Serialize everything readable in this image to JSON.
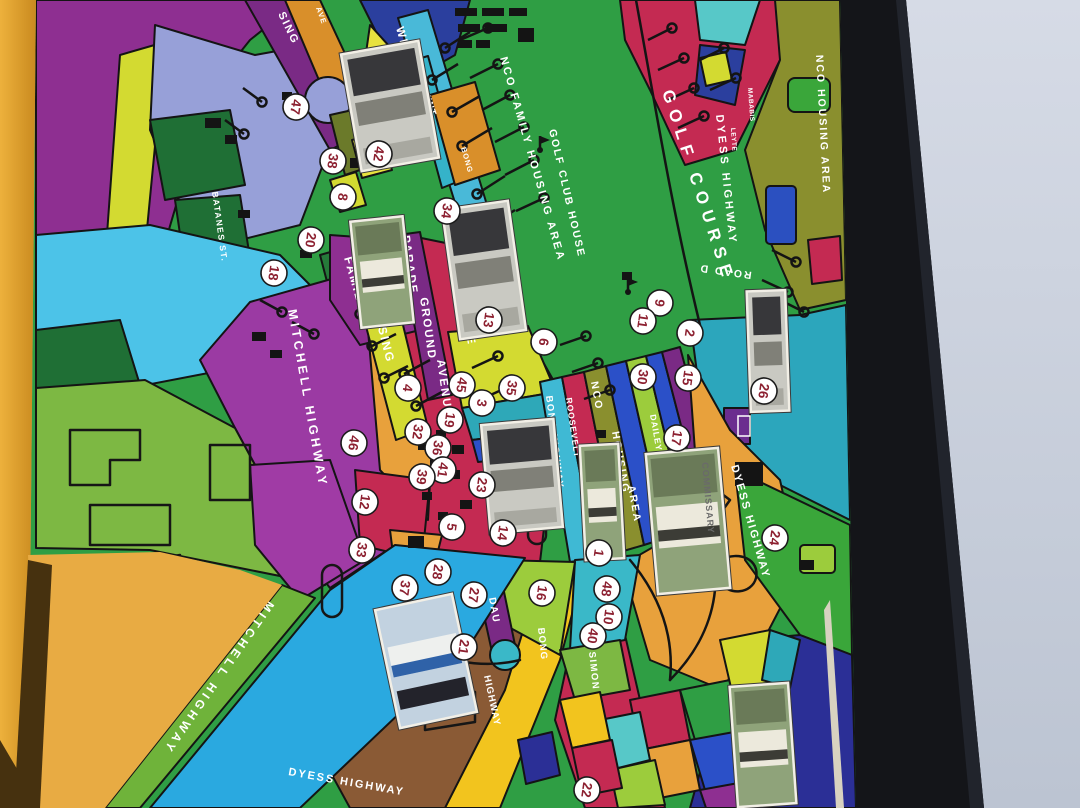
{
  "scene": {
    "left_wall_color": "#e09b2e",
    "right_wall_color": "#c9cfdb",
    "frame_color": "#141519",
    "map_edge_color": "#d8d2c0",
    "palette": {
      "golf_green": "#2f9e44",
      "lime_green": "#7db843",
      "purple": "#8e2f91",
      "violet_road": "#7a2a85",
      "crimson": "#c42a52",
      "cyan_road": "#2aa9e0",
      "teal": "#2ca6bc",
      "periwinkle": "#97a0d8",
      "olive": "#8a8f2e",
      "orange": "#e8a13c",
      "gold": "#f2c41e",
      "brown": "#8a5a35",
      "royal_blue": "#2b50c8",
      "navy": "#2b2f96",
      "yellow_green": "#d3da31"
    }
  },
  "map": {
    "marker_style": {
      "fill": "#ffffff",
      "text_color": "#8c2030"
    },
    "labels": [
      {
        "id": "golf-course",
        "text": "GOLF COURSE",
        "x": 662,
        "y": 92,
        "rot": 72,
        "size": 17,
        "ls": 7
      },
      {
        "id": "nco-family-housing-area",
        "text": "NCO FAMILY HOUSING AREA",
        "x": 500,
        "y": 58,
        "rot": 74,
        "size": 11,
        "ls": 2.5
      },
      {
        "id": "golf-club-house",
        "text": "GOLF CLUB HOUSE",
        "x": 549,
        "y": 130,
        "rot": 77,
        "size": 10.5,
        "ls": 2
      },
      {
        "id": "nco-housing-area-right",
        "text": "NCO HOUSING AREA",
        "x": 816,
        "y": 55,
        "rot": 87,
        "size": 10.5,
        "ls": 2
      },
      {
        "id": "dyess-highway-top",
        "text": "DYESS HIGHWAY",
        "x": 716,
        "y": 115,
        "rot": 84,
        "size": 11,
        "ls": 3
      },
      {
        "id": "road-d",
        "text": "ROAD D",
        "x": 752,
        "y": 272,
        "rot": 188,
        "size": 10.5,
        "ls": 2
      },
      {
        "id": "mababis-st",
        "text": "MABABIS",
        "x": 748,
        "y": 88,
        "rot": 86,
        "size": 6.5,
        "ls": 0.5
      },
      {
        "id": "leyte-st",
        "text": "LEYTE",
        "x": 731,
        "y": 128,
        "rot": 86,
        "size": 6.5,
        "ls": 0.5
      },
      {
        "id": "housing-top-left",
        "text": "SING",
        "x": 278,
        "y": 14,
        "rot": 64,
        "size": 11,
        "ls": 2
      },
      {
        "id": "ave-top-left",
        "text": "AVE",
        "x": 316,
        "y": 8,
        "rot": 70,
        "size": 7.5,
        "ls": 1
      },
      {
        "id": "batanes-st",
        "text": "BATANES ST.",
        "x": 212,
        "y": 192,
        "rot": 82,
        "size": 8.5,
        "ls": 1.5
      },
      {
        "id": "wint",
        "text": "WINT",
        "x": 422,
        "y": 90,
        "rot": 72,
        "size": 9.5,
        "ls": 1
      },
      {
        "id": "bong-top",
        "text": "BONG",
        "x": 461,
        "y": 148,
        "rot": 74,
        "size": 7.5,
        "ls": 1
      },
      {
        "id": "wirt-davis",
        "text": "WIRT DAVIS",
        "x": 396,
        "y": 28,
        "rot": 74,
        "size": 11.5,
        "ls": 2
      },
      {
        "id": "avenue-wirt-davis",
        "text": "AVENUE",
        "x": 458,
        "y": 288,
        "rot": 80,
        "size": 11.5,
        "ls": 2
      },
      {
        "id": "parade",
        "text": "PARADE",
        "x": 402,
        "y": 236,
        "rot": 82,
        "size": 11.5,
        "ls": 2
      },
      {
        "id": "ground",
        "text": "GROUND",
        "x": 420,
        "y": 298,
        "rot": 82,
        "size": 11.5,
        "ls": 2
      },
      {
        "id": "avenue-parade-ground",
        "text": "AVENUE",
        "x": 437,
        "y": 360,
        "rot": 82,
        "size": 11.5,
        "ls": 2
      },
      {
        "id": "family",
        "text": "FAMILY",
        "x": 344,
        "y": 258,
        "rot": 74,
        "size": 12,
        "ls": 2
      },
      {
        "id": "housing-family",
        "text": "HOUSING",
        "x": 370,
        "y": 296,
        "rot": 76,
        "size": 12,
        "ls": 2
      },
      {
        "id": "mitchell-highway-mid",
        "text": "MITCHELL HIGHWAY",
        "x": 288,
        "y": 310,
        "rot": 80,
        "size": 12.5,
        "ls": 3.5
      },
      {
        "id": "bong-highway-mid",
        "text": "BONG HIGHWAY",
        "x": 546,
        "y": 396,
        "rot": 83,
        "size": 9.5,
        "ls": 1.5
      },
      {
        "id": "roosevelt",
        "text": "ROOSEVELT",
        "x": 566,
        "y": 398,
        "rot": 82,
        "size": 8.5,
        "ls": 1
      },
      {
        "id": "nco-band",
        "text": "NCO",
        "x": 591,
        "y": 382,
        "rot": 80,
        "size": 10.5,
        "ls": 2
      },
      {
        "id": "housing-band",
        "text": "HOUSING",
        "x": 612,
        "y": 432,
        "rot": 80,
        "size": 10.5,
        "ls": 2
      },
      {
        "id": "area-band",
        "text": "AREA",
        "x": 628,
        "y": 486,
        "rot": 80,
        "size": 10.5,
        "ls": 2
      },
      {
        "id": "dailey",
        "text": "DAILEY",
        "x": 650,
        "y": 415,
        "rot": 80,
        "size": 8.5,
        "ls": 1
      },
      {
        "id": "dyess-highway-right",
        "text": "DYESS HIGHWAY",
        "x": 731,
        "y": 466,
        "rot": 74,
        "size": 11,
        "ls": 2
      },
      {
        "id": "dau",
        "text": "DAU",
        "x": 489,
        "y": 598,
        "rot": 80,
        "size": 10,
        "ls": 1.5
      },
      {
        "id": "bong-bottom",
        "text": "BONG",
        "x": 538,
        "y": 628,
        "rot": 84,
        "size": 9.5,
        "ls": 1
      },
      {
        "id": "highway-bottom",
        "text": "HIGHWAY",
        "x": 484,
        "y": 676,
        "rot": 78,
        "size": 9.5,
        "ls": 1
      },
      {
        "id": "simon",
        "text": "SIMON",
        "x": 589,
        "y": 652,
        "rot": 84,
        "size": 9.5,
        "ls": 1.5
      },
      {
        "id": "mitchell-highway-bottom",
        "text": "MITCHELL HIGHWAY",
        "x": 268,
        "y": 600,
        "rot": 125,
        "size": 12,
        "ls": 4
      },
      {
        "id": "to-friendship-gate",
        "text": "TO FRIENDSHIP GATE",
        "x": 118,
        "y": 738,
        "rot": 125,
        "size": 8,
        "ls": 1
      },
      {
        "id": "dyess-highway-bottom",
        "text": "DYESS HIGHWAY",
        "x": 288,
        "y": 775,
        "rot": 10,
        "size": 11,
        "ls": 2
      }
    ],
    "markers": [
      {
        "n": "47",
        "x": 296,
        "y": 107
      },
      {
        "n": "38",
        "x": 333,
        "y": 161
      },
      {
        "n": "42",
        "x": 379,
        "y": 154
      },
      {
        "n": "8",
        "x": 343,
        "y": 197
      },
      {
        "n": "20",
        "x": 311,
        "y": 240
      },
      {
        "n": "18",
        "x": 274,
        "y": 273
      },
      {
        "n": "34",
        "x": 447,
        "y": 211
      },
      {
        "n": "13",
        "x": 489,
        "y": 320
      },
      {
        "n": "6",
        "x": 544,
        "y": 342
      },
      {
        "n": "9",
        "x": 660,
        "y": 303
      },
      {
        "n": "11",
        "x": 643,
        "y": 321
      },
      {
        "n": "2",
        "x": 690,
        "y": 333
      },
      {
        "n": "15",
        "x": 688,
        "y": 378
      },
      {
        "n": "30",
        "x": 643,
        "y": 377
      },
      {
        "n": "26",
        "x": 764,
        "y": 391
      },
      {
        "n": "17",
        "x": 677,
        "y": 438
      },
      {
        "n": "45",
        "x": 462,
        "y": 385
      },
      {
        "n": "35",
        "x": 512,
        "y": 388
      },
      {
        "n": "3",
        "x": 482,
        "y": 403
      },
      {
        "n": "19",
        "x": 450,
        "y": 420
      },
      {
        "n": "4",
        "x": 408,
        "y": 388
      },
      {
        "n": "32",
        "x": 418,
        "y": 432
      },
      {
        "n": "36",
        "x": 438,
        "y": 448
      },
      {
        "n": "41",
        "x": 443,
        "y": 470
      },
      {
        "n": "39",
        "x": 422,
        "y": 477
      },
      {
        "n": "23",
        "x": 482,
        "y": 485
      },
      {
        "n": "46",
        "x": 354,
        "y": 443
      },
      {
        "n": "5",
        "x": 452,
        "y": 527
      },
      {
        "n": "14",
        "x": 503,
        "y": 533
      },
      {
        "n": "12",
        "x": 365,
        "y": 502
      },
      {
        "n": "33",
        "x": 362,
        "y": 550
      },
      {
        "n": "37",
        "x": 405,
        "y": 588
      },
      {
        "n": "28",
        "x": 438,
        "y": 572
      },
      {
        "n": "27",
        "x": 474,
        "y": 595
      },
      {
        "n": "21",
        "x": 464,
        "y": 647
      },
      {
        "n": "16",
        "x": 542,
        "y": 593
      },
      {
        "n": "1",
        "x": 599,
        "y": 553
      },
      {
        "n": "48",
        "x": 607,
        "y": 589
      },
      {
        "n": "10",
        "x": 609,
        "y": 617
      },
      {
        "n": "40",
        "x": 593,
        "y": 636
      },
      {
        "n": "22",
        "x": 587,
        "y": 790
      },
      {
        "n": "24",
        "x": 775,
        "y": 538
      }
    ],
    "photos": [
      {
        "id": "headquarters-building",
        "x": 352,
        "y": 48,
        "w": 76,
        "h": 116,
        "rot": -10,
        "tint": "bw"
      },
      {
        "id": "flag-building",
        "x": 357,
        "y": 220,
        "w": 50,
        "h": 104,
        "rot": -6,
        "tint": "green"
      },
      {
        "id": "aerial-building",
        "x": 452,
        "y": 206,
        "w": 64,
        "h": 128,
        "rot": -8,
        "tint": "bw"
      },
      {
        "id": "chapel-building",
        "x": 487,
        "y": 423,
        "w": 70,
        "h": 106,
        "rot": -5,
        "tint": "bw"
      },
      {
        "id": "white-house",
        "x": 584,
        "y": 446,
        "w": 36,
        "h": 112,
        "rot": -3,
        "tint": "green"
      },
      {
        "id": "commissary",
        "x": 653,
        "y": 452,
        "w": 70,
        "h": 138,
        "rot": -5,
        "tint": "green",
        "caption": "COMMISSARY"
      },
      {
        "id": "bus-depot",
        "x": 388,
        "y": 602,
        "w": 76,
        "h": 118,
        "rot": -12,
        "tint": "blue"
      },
      {
        "id": "tall-building",
        "x": 750,
        "y": 292,
        "w": 36,
        "h": 118,
        "rot": -2,
        "tint": "bw"
      },
      {
        "id": "aerial-white-building",
        "x": 735,
        "y": 686,
        "w": 56,
        "h": 118,
        "rot": -4,
        "tint": "green"
      }
    ]
  }
}
